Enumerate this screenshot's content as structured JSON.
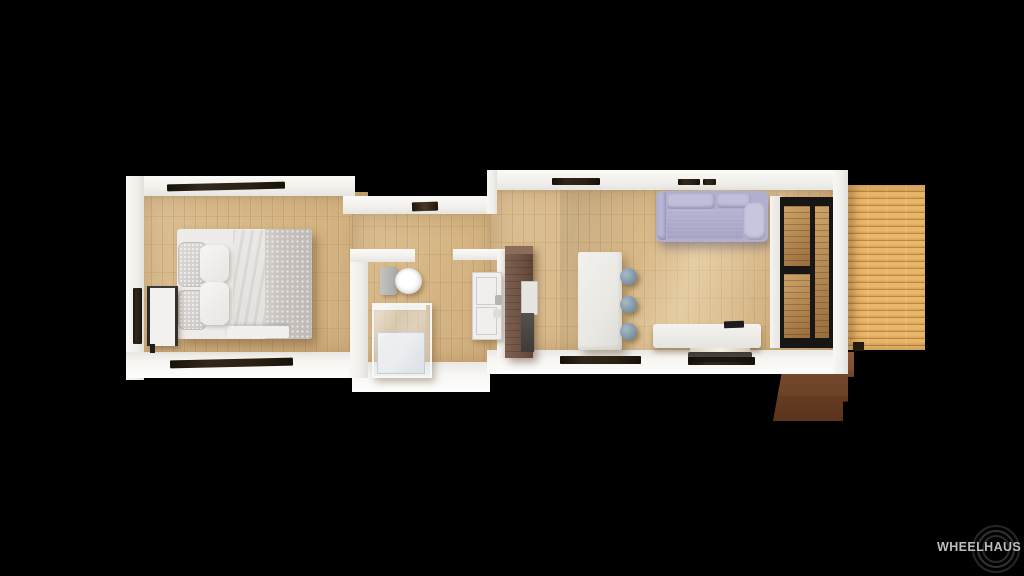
{
  "scene": {
    "width": 1024,
    "height": 576,
    "background": "#000000",
    "subject": "Top-down 3D rendered floor plan of a long single-unit tiny home (bedroom, bathroom, kitchen, living room) with a wood deck and entry steps on the right"
  },
  "logo": {
    "text": "WHEELHAUS",
    "text_color": "#bdbdbd",
    "ring_color": "#333333"
  },
  "palette": {
    "background": "#000000",
    "wall_white": "#f2f1ed",
    "interior_floor_wood": "#d8ba8c",
    "deck_wood": "#dfa763",
    "steps_brown": "#74482b",
    "window_slit_dark": "#241c12",
    "sofa_lavender": "#b7b5d3",
    "stool_blue_gray": "#8fa3b1",
    "tall_cabinet_brown": "#6f5443",
    "glass_door_frame": "#171614",
    "bed_linen_white": "#edecea",
    "duvet_gray_pattern": "#c8c3bf"
  }
}
